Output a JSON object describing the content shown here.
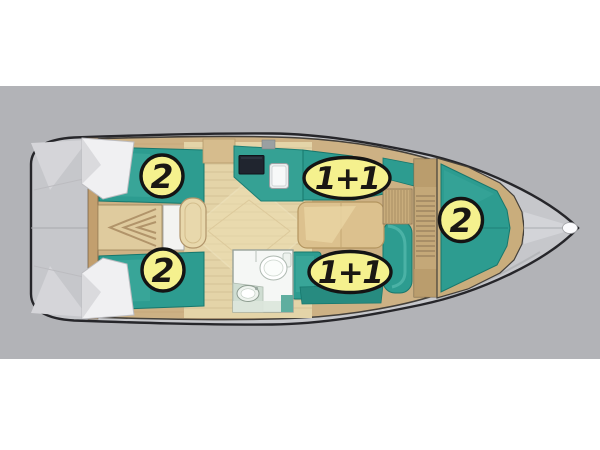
{
  "diagram": {
    "kind": "sailboat-berth-layout-plan",
    "orientation": "bow-right",
    "badges": {
      "aft_cabin_port": "2",
      "saloon_port": "1+1",
      "aft_cabin_starboard": "2",
      "saloon_starboard": "1+1",
      "forward_cabin": "2"
    },
    "colors": {
      "page_background": "#ffffff",
      "background_band": "#b2b3b7",
      "hull_deck": "#c6c7cb",
      "hull_outline": "#26262a",
      "cushion_teal": "#2d9c90",
      "cushion_teal_dark": "#17776d",
      "wood_floor_light": "#e4d4a8",
      "wood_trim": "#cdb184",
      "badge_fill": "#f5f18e",
      "badge_border": "#141414",
      "badge_text": "#1a1713"
    }
  }
}
